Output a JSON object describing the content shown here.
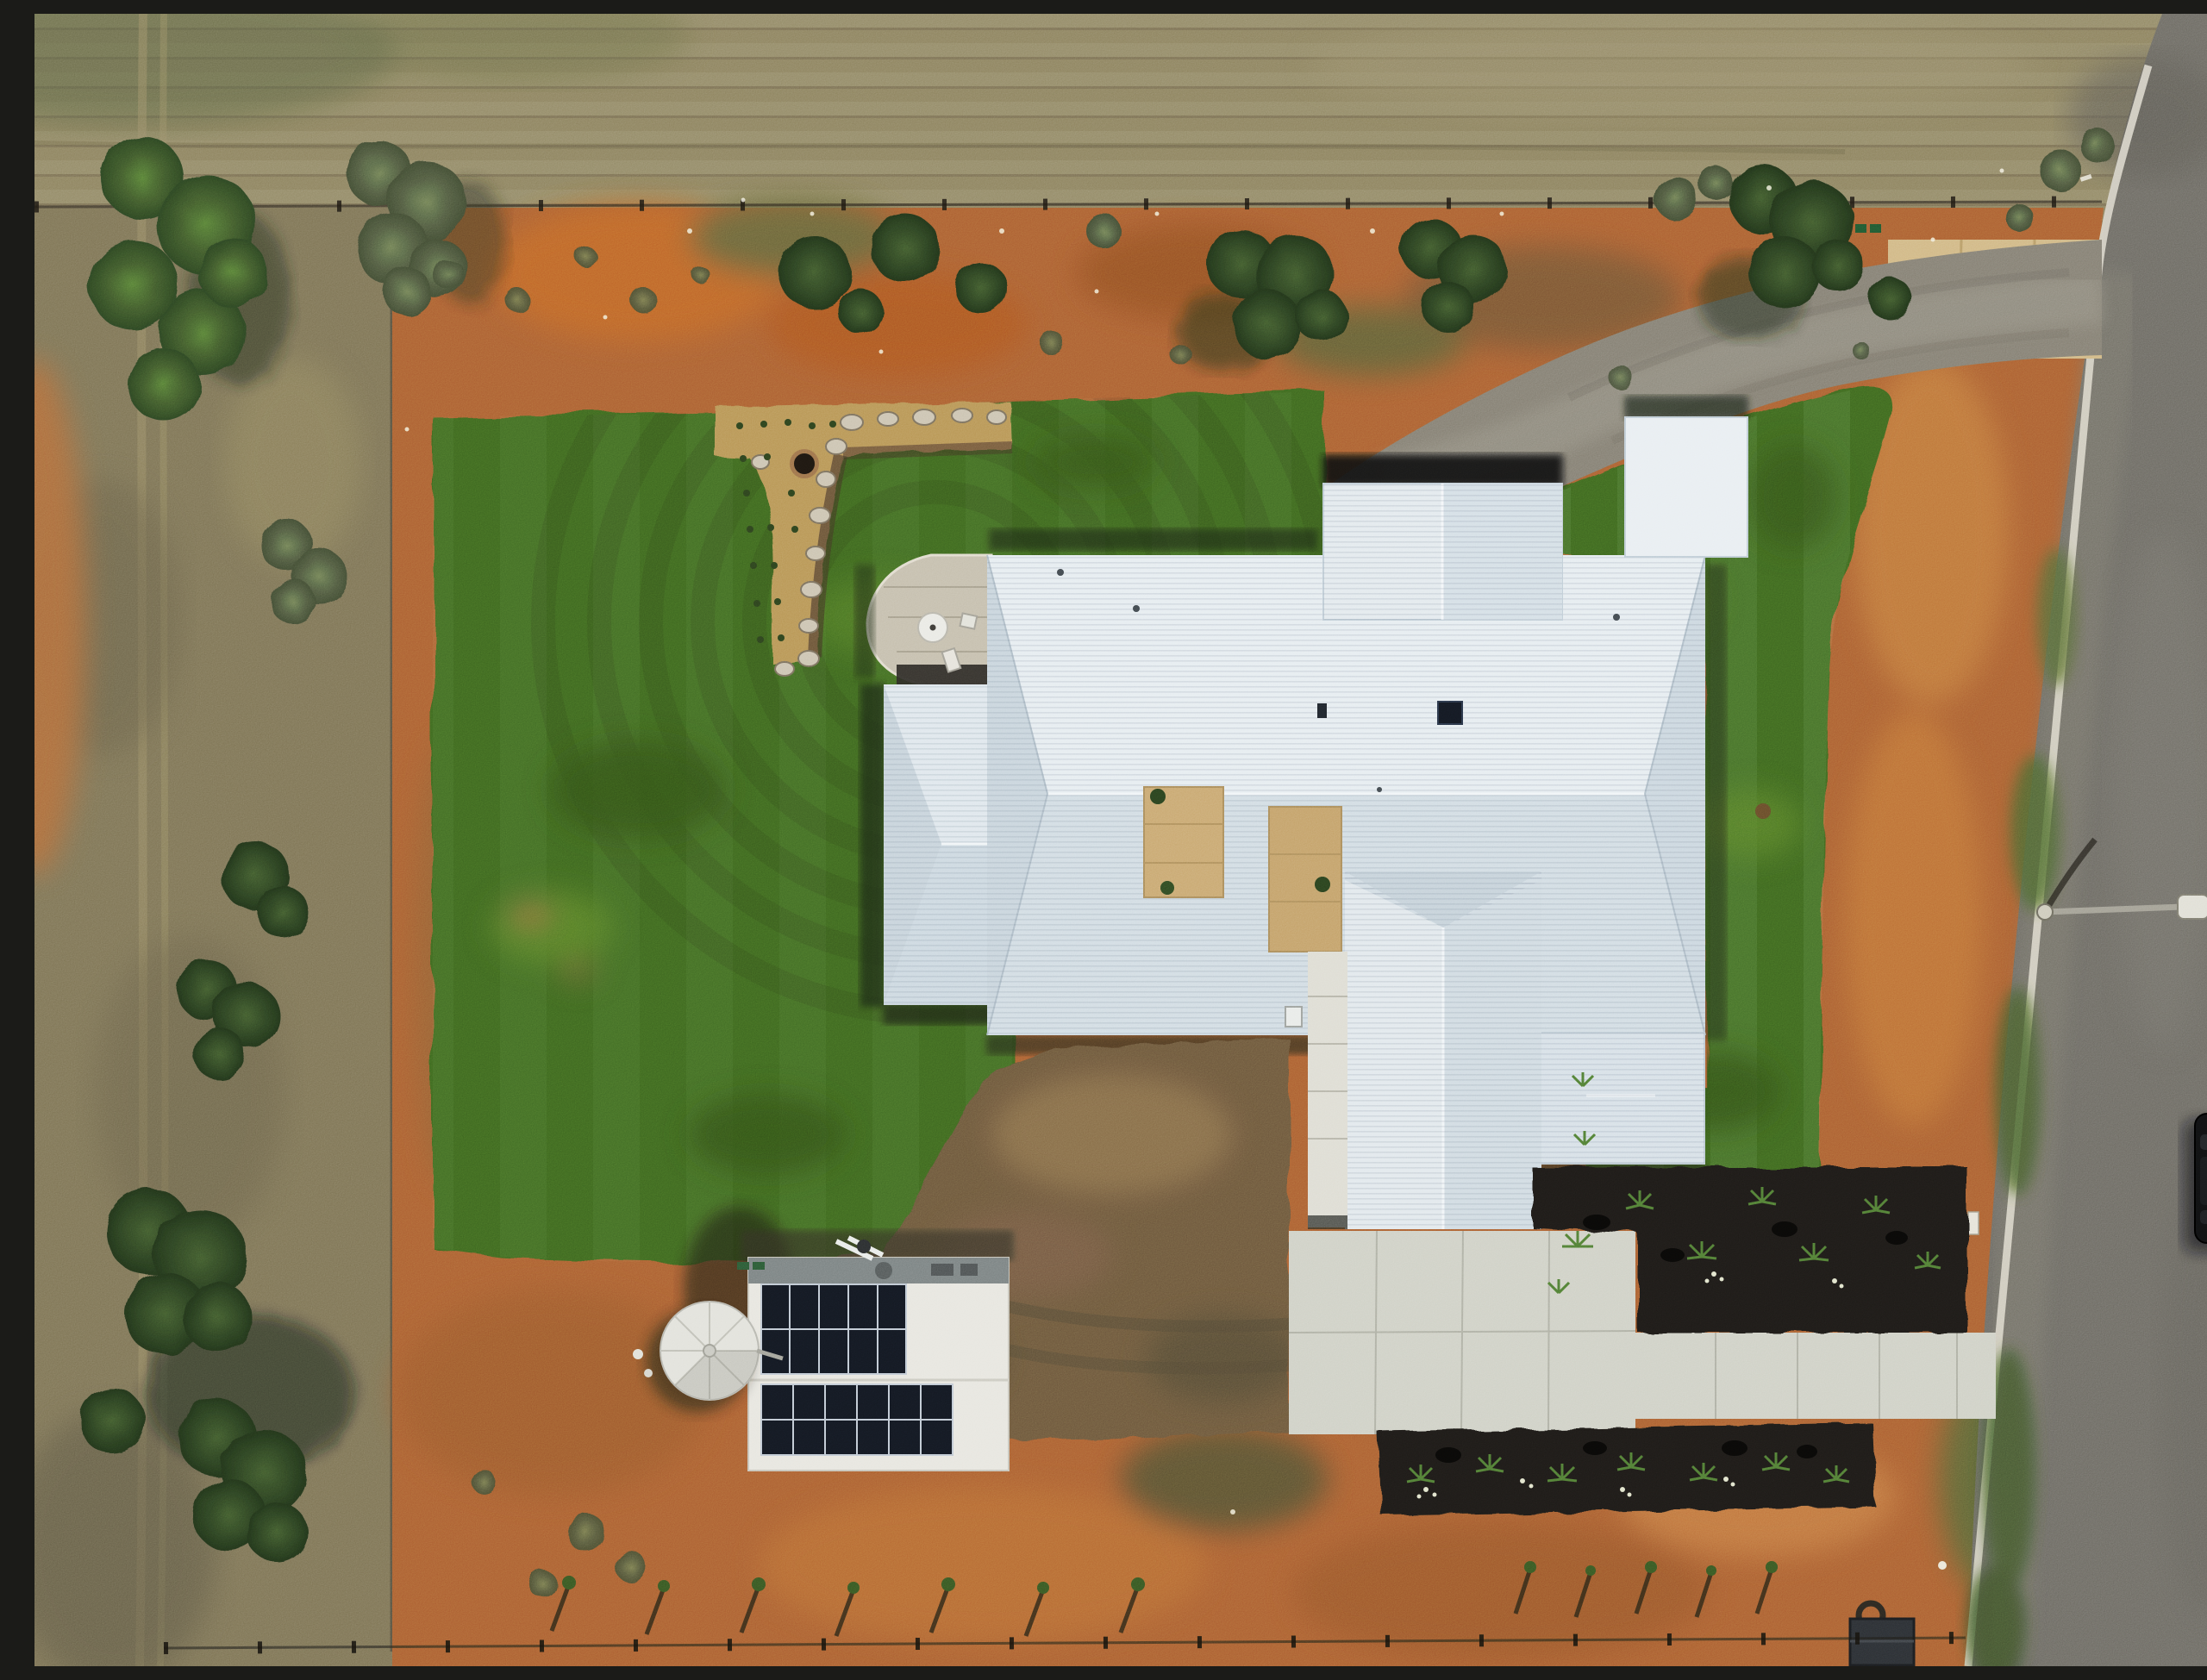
{
  "meta": {
    "title": "Aerial drone photograph — new rural home with white roof, lawns and shed"
  },
  "palette": {
    "paddock": "#a9a184",
    "scrub": "#9d9579",
    "dirt": "#c08448",
    "lawn": "#598a2e",
    "roof": "#e4ebf0",
    "concrete": "#a29e94",
    "apron": "#dcc9a2",
    "pad": "#dbdcd4",
    "road": "#908e88",
    "curb": "#dedbd2",
    "mulch": "#2b2724",
    "panel": "#1c2330",
    "trav": "#d6bd92",
    "gravel": "#8f7b57",
    "tank": "#e9e9e4",
    "shedRoof": "#edece7",
    "stone": "#d3cec1"
  },
  "scene": {
    "labels": {
      "photo": "Top-down aerial photo of a rural property with a new white-roofed house",
      "paddock": "Dry slashed paddock beyond the north boundary fence",
      "scrub": "Dry scrub along the western boundary",
      "road": "Asphalt road along the eastern boundary",
      "crossover": "Concrete driveway crossover",
      "driveway": "Curved concrete driveway to the north garage",
      "house": "White metal hip-and-valley roofed house",
      "garage_court": "North garage entry in shadow",
      "courtyard": "Internal travertine courtyard",
      "entry_walk": "Travertine entry walk and paved path",
      "patio": "Curved stone patio with outdoor table and chairs",
      "left_lawn": "Large western lawn",
      "top_lawn": "Lawn strip north of the house",
      "right_lawn": "Eastern lawn",
      "rock_garden": "Rock-edged garden corner with fire pit and tube-stock plants",
      "fire_pit": "Fire pit",
      "gravel_drive": "Gravel service driveway",
      "pad": "Concrete apron in front of the south garage",
      "path": "Concrete path to the road",
      "mailbox": "Letterbox post",
      "shed": "Garden shed with rooftop solar arrays",
      "solar_upper": "Upper solar panel array",
      "solar_lower": "Lower solar panel array",
      "tank": "Round rainwater tank",
      "bed_upper": "Mulched garden bed below eastern lawn",
      "bed_lower": "Mulched garden bed along the path",
      "saplings": "Rows of newly planted saplings",
      "streetlight": "Street light arm over the road with curved shadow",
      "vehicle": "Dark vehicle parked at the road edge",
      "fence_north": "North boundary fence",
      "fence_south": "South boundary fence with posts",
      "trees": "Scattered native trees and shrubs",
      "trailer": "Small trailer near south fence",
      "utility_boxes": "Green utility service boxes"
    },
    "solar": {
      "upper_columns": 5,
      "lower_columns": 6,
      "rows_per_array": 2
    },
    "tank_segments": 8,
    "furniture": {
      "round_table": 1,
      "chairs": 2
    },
    "sapling_rows": 2
  }
}
